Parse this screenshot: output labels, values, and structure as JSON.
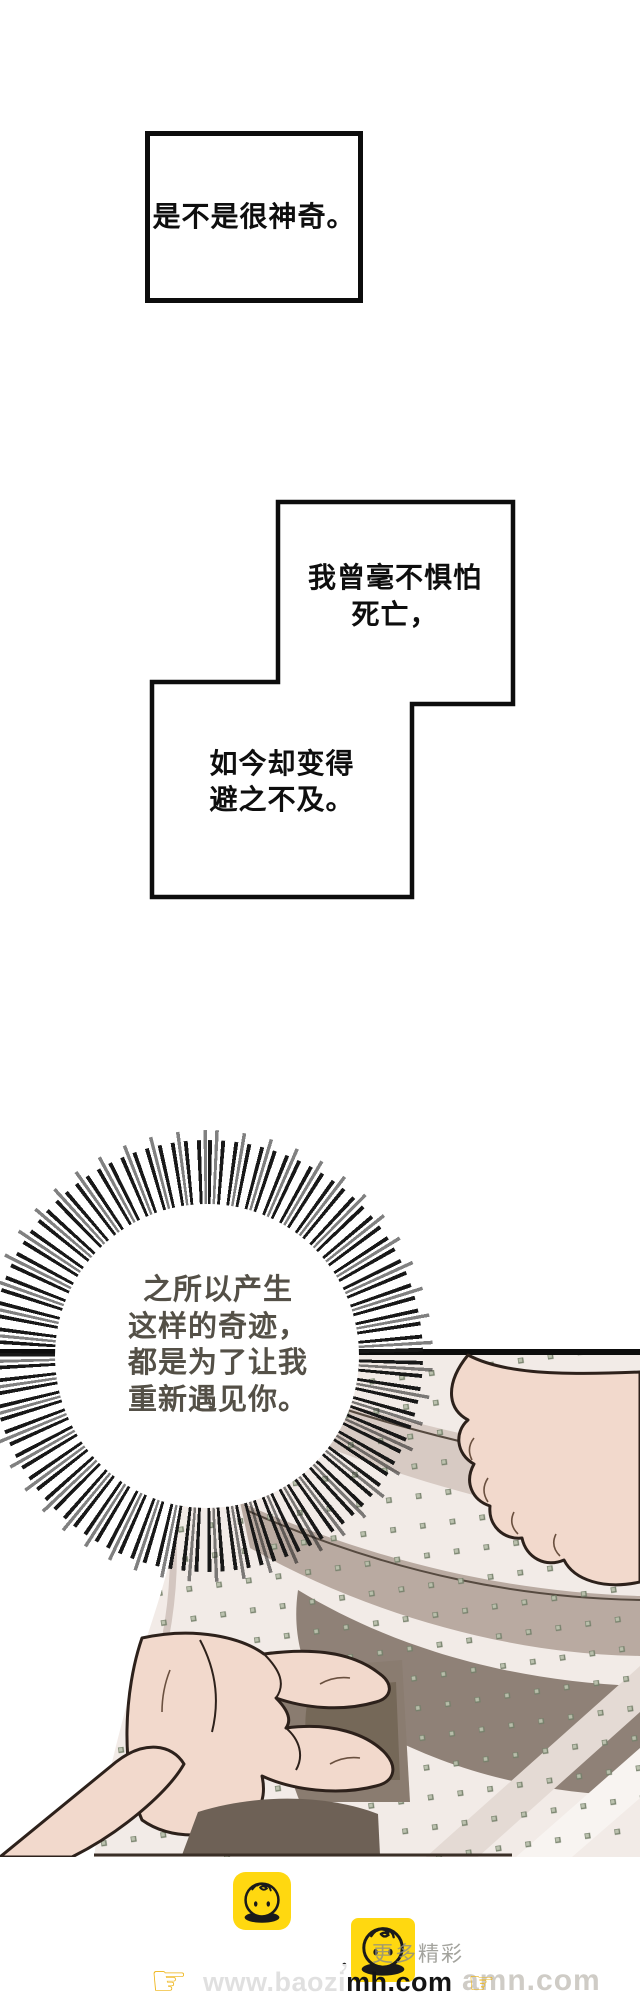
{
  "page_type": "webtoon-comic-page",
  "speech_boxes": {
    "box1": {
      "text": "是不是很神奇。"
    },
    "box2": {
      "lines": [
        "我曾毫不惧怕",
        "死亡，"
      ]
    },
    "box3": {
      "lines": [
        "如今却变得",
        "避之不及。"
      ]
    }
  },
  "burst_bubble": {
    "lines": [
      "之所以产生",
      "这样的奇迹，",
      "都是为了让我",
      "重新遇见你。"
    ]
  },
  "footer": {
    "site_url": "www.baozimh.com",
    "site_url_ghost": "amn.com",
    "more_label": "更多精彩",
    "comma_mark": "，",
    "finger_glyph": "☞",
    "icon_name": "baozi-bun-mascot"
  },
  "colors": {
    "panel_border": "#0d0d0d",
    "burst_text": "#545047",
    "fabric_base": "#f2ebe7",
    "fabric_fold_light": "#d7cac3",
    "fabric_fold_mid": "#b9aaa1",
    "fabric_fold_dark": "#8f8177",
    "skin": "#f2d9cc",
    "outline": "#2d211b",
    "dot_olive": "#75806a",
    "brand_yellow": "#ffd810"
  }
}
